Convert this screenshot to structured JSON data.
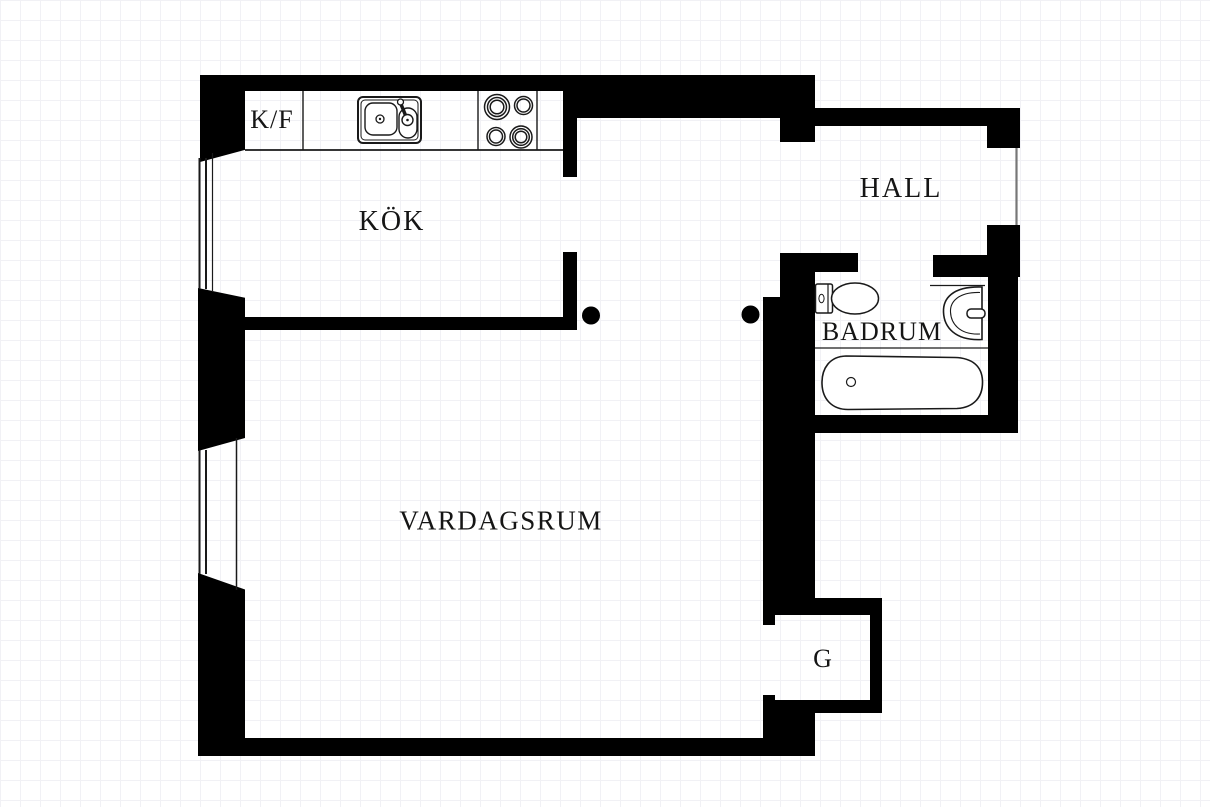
{
  "floorplan": {
    "rooms": {
      "fridge_freezer_label": "K/F",
      "kitchen_label": "KÖK",
      "hall_label": "HALL",
      "bathroom_label": "BADRUM",
      "living_room_label": "VARDAGSRUM",
      "closet_label": "G"
    },
    "fixtures": [
      "kitchen-counter",
      "kitchen-sink",
      "stove-four-burners",
      "toilet",
      "washbasin",
      "bathtub",
      "window",
      "window",
      "door-dot",
      "door-dot",
      "entry-opening"
    ],
    "colors": {
      "wall": "#000000",
      "background": "#ffffff",
      "grid_line": "#f1f1f5",
      "text": "#151515"
    }
  }
}
